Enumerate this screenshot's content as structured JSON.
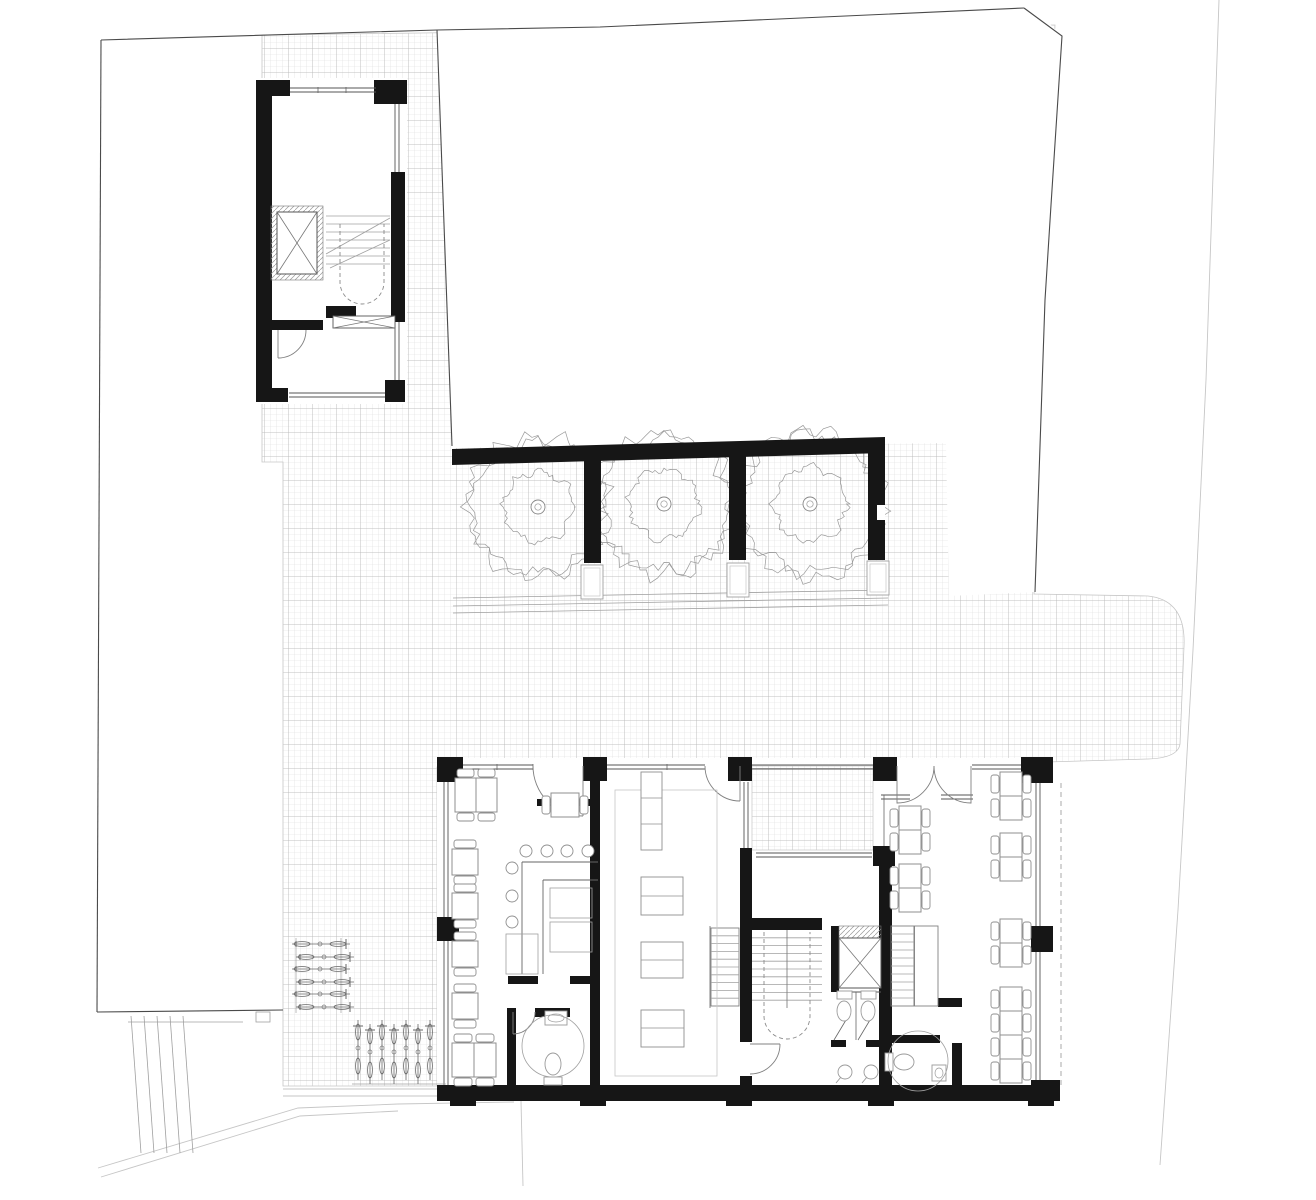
{
  "document": {
    "type": "architectural-ground-floor-plan",
    "width": 1316,
    "height": 1200,
    "background": "#ffffff"
  },
  "palette": {
    "wall": "#161616",
    "line_dark": "#4a4a4a",
    "line": "#666666",
    "line_mid": "#808080",
    "line_light": "#a0a0a0",
    "line_faint": "#c6c6c6",
    "hatch_fine": "#dcdcdc",
    "hatch_coarse": "#b4b4b4",
    "furniture": "#8f8f8f",
    "fixture": "#9a9a9a",
    "tree": "#999999",
    "white": "#ffffff"
  },
  "hatch": {
    "plaza": "M262,35 L1055,25 L1045,210 L1034,594 L1148,596 Q1186,600 1184,646 L1180,744 Q1178,758 1148,759 L1047,762 L437,767 L437,1086 L283,1086 L283,462 L262,462 Z",
    "lightwell": [
      752,
      766,
      121,
      84
    ]
  },
  "white": {
    "neighbor": "M437,30 L1024,8 Q1038,7 1044,18 L1062,36 L1051,205 L1045,300 L1035,592 L949,596 L946,443 L452,448 Z",
    "annex_floor": [
      256,
      78,
      151,
      326
    ],
    "main_floor": [
      437,
      758,
      616,
      343
    ],
    "notches": [
      [
        877,
        505,
        8,
        15
      ]
    ]
  },
  "site": {
    "dark": [
      [
        [
          101,
          40
        ],
        [
          437,
          30
        ],
        [
          600,
          27
        ],
        [
          1024,
          8
        ]
      ],
      [
        [
          1024,
          8
        ],
        [
          1062,
          36
        ],
        [
          1051,
          205
        ],
        [
          1045,
          300
        ],
        [
          1035,
          592
        ]
      ],
      [
        [
          437,
          30
        ],
        [
          452,
          446
        ]
      ],
      [
        [
          101,
          40
        ],
        [
          97,
          1012
        ]
      ],
      [
        [
          97,
          1012
        ],
        [
          283,
          1010
        ]
      ]
    ],
    "faint": [
      [
        [
          1219,
          0
        ],
        [
          1206,
          380
        ],
        [
          1193,
          650
        ],
        [
          1178,
          910
        ],
        [
          1160,
          1165
        ]
      ],
      [
        [
          98,
          1168
        ],
        [
          298,
          1108
        ],
        [
          398,
          1104
        ],
        [
          514,
          1102
        ]
      ],
      [
        [
          101,
          1177
        ],
        [
          300,
          1116
        ],
        [
          398,
          1111
        ]
      ],
      [
        [
          521,
          1101
        ],
        [
          523,
          1186
        ]
      ],
      [
        [
          283,
          1089
        ],
        [
          437,
          1089
        ]
      ],
      [
        [
          283,
          1096
        ],
        [
          437,
          1096
        ]
      ]
    ],
    "light": [
      [
        453,
        598,
        888,
        590
      ],
      [
        453,
        606,
        888,
        598
      ],
      [
        453,
        613,
        888,
        605
      ],
      [
        131,
        1016,
        141,
        1153
      ],
      [
        144,
        1016,
        154,
        1153
      ],
      [
        157,
        1016,
        167,
        1153
      ],
      [
        170,
        1016,
        180,
        1153
      ],
      [
        183,
        1016,
        193,
        1153
      ],
      [
        128,
        1022,
        243,
        1022
      ]
    ],
    "light_rects": [
      [
        256,
        1012,
        14,
        10
      ]
    ],
    "dashed": [
      [
        1061,
        783,
        1061,
        1085
      ]
    ]
  },
  "walls": {
    "black_rects": [
      [
        256,
        80,
        16,
        322
      ],
      [
        256,
        80,
        34,
        16
      ],
      [
        374,
        80,
        33,
        24
      ],
      [
        391,
        172,
        14,
        150
      ],
      [
        385,
        380,
        20,
        22
      ],
      [
        256,
        388,
        32,
        14
      ],
      [
        271,
        320,
        52,
        10
      ],
      [
        326,
        306,
        30,
        12
      ],
      [
        584,
        453,
        17,
        110
      ],
      [
        729,
        450,
        17,
        110
      ],
      [
        868,
        447,
        17,
        113
      ],
      [
        437,
        757,
        26,
        25
      ],
      [
        583,
        757,
        24,
        24
      ],
      [
        728,
        757,
        24,
        24
      ],
      [
        873,
        757,
        24,
        24
      ],
      [
        1021,
        757,
        32,
        26
      ],
      [
        437,
        917,
        22,
        24
      ],
      [
        1031,
        926,
        22,
        26
      ],
      [
        1031,
        1080,
        29,
        21
      ],
      [
        437,
        1085,
        616,
        16
      ],
      [
        450,
        1101,
        26,
        5
      ],
      [
        580,
        1101,
        26,
        5
      ],
      [
        726,
        1101,
        26,
        5
      ],
      [
        868,
        1101,
        26,
        5
      ],
      [
        1028,
        1101,
        26,
        5
      ],
      [
        590,
        781,
        10,
        304
      ],
      [
        537,
        799,
        53,
        7
      ],
      [
        508,
        976,
        30,
        8
      ],
      [
        570,
        976,
        28,
        8
      ],
      [
        507,
        1008,
        9,
        77
      ],
      [
        535,
        1008,
        35,
        9
      ],
      [
        740,
        848,
        12,
        194
      ],
      [
        740,
        1076,
        12,
        9
      ],
      [
        873,
        846,
        22,
        20
      ],
      [
        879,
        846,
        13,
        239
      ],
      [
        752,
        918,
        70,
        12
      ],
      [
        831,
        926,
        8,
        66
      ],
      [
        831,
        1040,
        15,
        7
      ],
      [
        866,
        1040,
        15,
        7
      ],
      [
        938,
        998,
        24,
        9
      ],
      [
        885,
        1035,
        55,
        8
      ],
      [
        952,
        1043,
        10,
        42
      ]
    ],
    "polys": [
      [
        [
          452,
          449
        ],
        [
          885,
          437
        ],
        [
          885,
          453
        ],
        [
          452,
          465
        ]
      ]
    ]
  },
  "windows_double": [
    {
      "x1": 290,
      "y1": 90,
      "x2": 376,
      "y2": 90
    },
    {
      "x1": 397,
      "y1": 104,
      "x2": 397,
      "y2": 172
    },
    {
      "x1": 397,
      "y1": 322,
      "x2": 397,
      "y2": 380
    },
    {
      "x1": 289,
      "y1": 395,
      "x2": 385,
      "y2": 395
    },
    {
      "x1": 463,
      "y1": 767,
      "x2": 533,
      "y2": 767
    },
    {
      "x1": 607,
      "y1": 767,
      "x2": 705,
      "y2": 767
    },
    {
      "x1": 752,
      "y1": 767,
      "x2": 873,
      "y2": 767
    },
    {
      "x1": 972,
      "y1": 767,
      "x2": 1021,
      "y2": 767
    },
    {
      "x1": 446,
      "y1": 782,
      "x2": 446,
      "y2": 917
    },
    {
      "x1": 446,
      "y1": 941,
      "x2": 446,
      "y2": 1085
    },
    {
      "x1": 1038,
      "y1": 783,
      "x2": 1038,
      "y2": 926
    },
    {
      "x1": 1038,
      "y1": 952,
      "x2": 1038,
      "y2": 1080
    },
    {
      "x1": 746,
      "y1": 782,
      "x2": 746,
      "y2": 848
    },
    {
      "x1": 756,
      "y1": 855,
      "x2": 872,
      "y2": 855
    },
    {
      "x1": 881,
      "y1": 797,
      "x2": 910,
      "y2": 797
    },
    {
      "x1": 941,
      "y1": 797,
      "x2": 973,
      "y2": 797
    },
    {
      "x1": 839,
      "y1": 990,
      "x2": 881,
      "y2": 990
    }
  ],
  "thin_lines": [
    [
      884,
      795,
      884,
      846
    ],
    [
      856,
      992,
      856,
      1040
    ],
    [
      710,
      926,
      710,
      1008
    ],
    [
      834,
      1040,
      846,
      1020
    ],
    [
      858,
      1040,
      870,
      1020
    ],
    [
      914,
      926,
      914,
      1006
    ],
    [
      497,
      764,
      497,
      770
    ],
    [
      533,
      764,
      533,
      770
    ],
    [
      667,
      764,
      667,
      770
    ],
    [
      318,
      87,
      318,
      93
    ],
    [
      346,
      87,
      346,
      93
    ]
  ],
  "doors": [
    "M278,330 L278,358 M306,330 A28,28 0 0 1 278,358",
    "M583,766 L583,816 M533,766 A50,50 0 0 0 583,816",
    "M740,766 L740,801 M705,766 A35,35 0 0 0 740,801",
    "M897,766 L897,803 A37,37 0 0 0 934,766",
    "M971,766 L971,803 A37,37 0 0 1 934,766",
    "M513,1012 L513,1034 M535,1012 A22,22 0 0 1 513,1034",
    "M750,1044 L780,1044 M780,1044 A30,30 0 0 1 750,1074"
  ],
  "stairs": [
    {
      "x": 326,
      "y": 208,
      "w": 64,
      "h": 64,
      "n": 8,
      "outline": false,
      "half": false,
      "divider": false,
      "diagonals": [
        [
          326,
          254,
          390,
          218
        ],
        [
          330,
          268,
          390,
          240
        ]
      ]
    },
    {
      "x": 711,
      "y": 928,
      "w": 28,
      "h": 78,
      "n": 10,
      "outline": true,
      "half": false,
      "divider": false,
      "diagonals": []
    },
    {
      "x": 752,
      "y": 930,
      "w": 70,
      "h": 78,
      "n": 10,
      "outline": false,
      "half": false,
      "divider": true,
      "diagonals": []
    },
    {
      "x": 891,
      "y": 926,
      "w": 47,
      "h": 80,
      "n": 10,
      "outline": true,
      "half": true,
      "divider": true,
      "diagonals": []
    }
  ],
  "u_arrows": [
    {
      "x1": 340,
      "x2": 384,
      "ytop": 224,
      "ybot": 282
    },
    {
      "x1": 764,
      "x2": 810,
      "ytop": 932,
      "ybot": 1016
    }
  ],
  "elevators": [
    {
      "frame": [
        271,
        206,
        52,
        74
      ],
      "cab": [
        277,
        212,
        40,
        62
      ]
    },
    {
      "frame": [
        839,
        926,
        42,
        62
      ],
      "cab": [
        839,
        938,
        42,
        50
      ]
    }
  ],
  "xboxes": [
    [
      333,
      316,
      62,
      12
    ]
  ],
  "trees": [
    {
      "cx": 538,
      "cy": 507,
      "r": 70,
      "seed": 11
    },
    {
      "cx": 664,
      "cy": 504,
      "r": 70,
      "seed": 23
    },
    {
      "cx": 810,
      "cy": 504,
      "r": 73,
      "seed": 37
    }
  ],
  "planters": [
    [
      581,
      565,
      22,
      34
    ],
    [
      727,
      563,
      22,
      34
    ],
    [
      867,
      561,
      22,
      34
    ]
  ],
  "tables_single": [
    {
      "x": 455,
      "y": 778,
      "w": 21,
      "h": 34,
      "chairs": "tb"
    },
    {
      "x": 476,
      "y": 778,
      "w": 21,
      "h": 34,
      "chairs": "tb"
    },
    {
      "x": 452,
      "y": 849,
      "w": 26,
      "h": 26,
      "chairs": "tb"
    },
    {
      "x": 452,
      "y": 893,
      "w": 26,
      "h": 26,
      "chairs": "tb"
    },
    {
      "x": 452,
      "y": 941,
      "w": 26,
      "h": 26,
      "chairs": "tb"
    },
    {
      "x": 452,
      "y": 993,
      "w": 26,
      "h": 26,
      "chairs": "tb"
    },
    {
      "x": 452,
      "y": 1043,
      "w": 22,
      "h": 34,
      "chairs": "tb"
    },
    {
      "x": 474,
      "y": 1043,
      "w": 22,
      "h": 34,
      "chairs": "tb"
    },
    {
      "x": 551,
      "y": 793,
      "w": 28,
      "h": 24,
      "chairs": "lr"
    }
  ],
  "clusters4": [
    {
      "x": 899,
      "y": 806
    },
    {
      "x": 899,
      "y": 864
    },
    {
      "x": 1000,
      "y": 772
    },
    {
      "x": 1000,
      "y": 833
    },
    {
      "x": 1000,
      "y": 919
    },
    {
      "x": 1000,
      "y": 987
    },
    {
      "x": 1000,
      "y": 1035
    }
  ],
  "stools": [
    [
      526,
      851
    ],
    [
      547,
      851
    ],
    [
      567,
      851
    ],
    [
      588,
      851
    ],
    [
      512,
      868
    ],
    [
      512,
      896
    ],
    [
      512,
      922
    ]
  ],
  "bar": {
    "lines": [
      [
        522,
        862,
        598,
        862
      ],
      [
        522,
        862,
        522,
        974
      ],
      [
        543,
        880,
        598,
        880
      ],
      [
        543,
        880,
        543,
        974
      ]
    ],
    "rects": [
      [
        506,
        934,
        32,
        40
      ],
      [
        550,
        888,
        42,
        30
      ],
      [
        550,
        922,
        42,
        30
      ]
    ]
  },
  "kitchen": {
    "floor_outline": [
      615,
      790,
      102,
      286
    ],
    "counters": [
      {
        "rect": [
          641,
          772,
          21,
          78
        ],
        "dividers": [
          798,
          824
        ]
      },
      {
        "rect": [
          641,
          877,
          42,
          38
        ],
        "dividers": [
          896
        ]
      },
      {
        "rect": [
          641,
          942,
          42,
          36
        ],
        "dividers": [
          960
        ]
      },
      {
        "rect": [
          641,
          1010,
          43,
          37
        ],
        "dividers": [
          1028
        ]
      }
    ]
  },
  "toilets": [
    {
      "tank": [
        837,
        991,
        15,
        8
      ],
      "bowl": [
        844,
        1011,
        7,
        10
      ]
    },
    {
      "tank": [
        861,
        991,
        15,
        8
      ],
      "bowl": [
        868,
        1011,
        7,
        10
      ]
    },
    {
      "tank": [
        544,
        1077,
        18,
        8
      ],
      "bowl": [
        553,
        1064,
        8,
        11
      ]
    },
    {
      "tank": [
        885,
        1053,
        8,
        18
      ],
      "bowl": [
        904,
        1062,
        10,
        8
      ]
    }
  ],
  "sinks_round": [
    {
      "cx": 845,
      "cy": 1072,
      "r": 7
    },
    {
      "cx": 871,
      "cy": 1072,
      "r": 7
    }
  ],
  "sinks_rect": [
    [
      545,
      1011,
      22,
      14
    ],
    [
      932,
      1065,
      14,
      16
    ]
  ],
  "wc_circles": [
    {
      "cx": 553,
      "cy": 1046,
      "r": 31
    },
    {
      "cx": 918,
      "cy": 1061,
      "r": 30
    }
  ],
  "bikes_h": {
    "x": 292,
    "len": 58,
    "ys": [
      944,
      957,
      969,
      982,
      994,
      1007
    ],
    "racks": [
      [
        296,
        938,
        296,
        1013
      ],
      [
        341,
        938,
        341,
        1013
      ]
    ]
  },
  "bikes_v": {
    "y": 1020,
    "len": 60,
    "xs": [
      358,
      370,
      382,
      394,
      406,
      418,
      430
    ],
    "racks": [
      [
        352,
        1084,
        446,
        1084
      ]
    ]
  }
}
